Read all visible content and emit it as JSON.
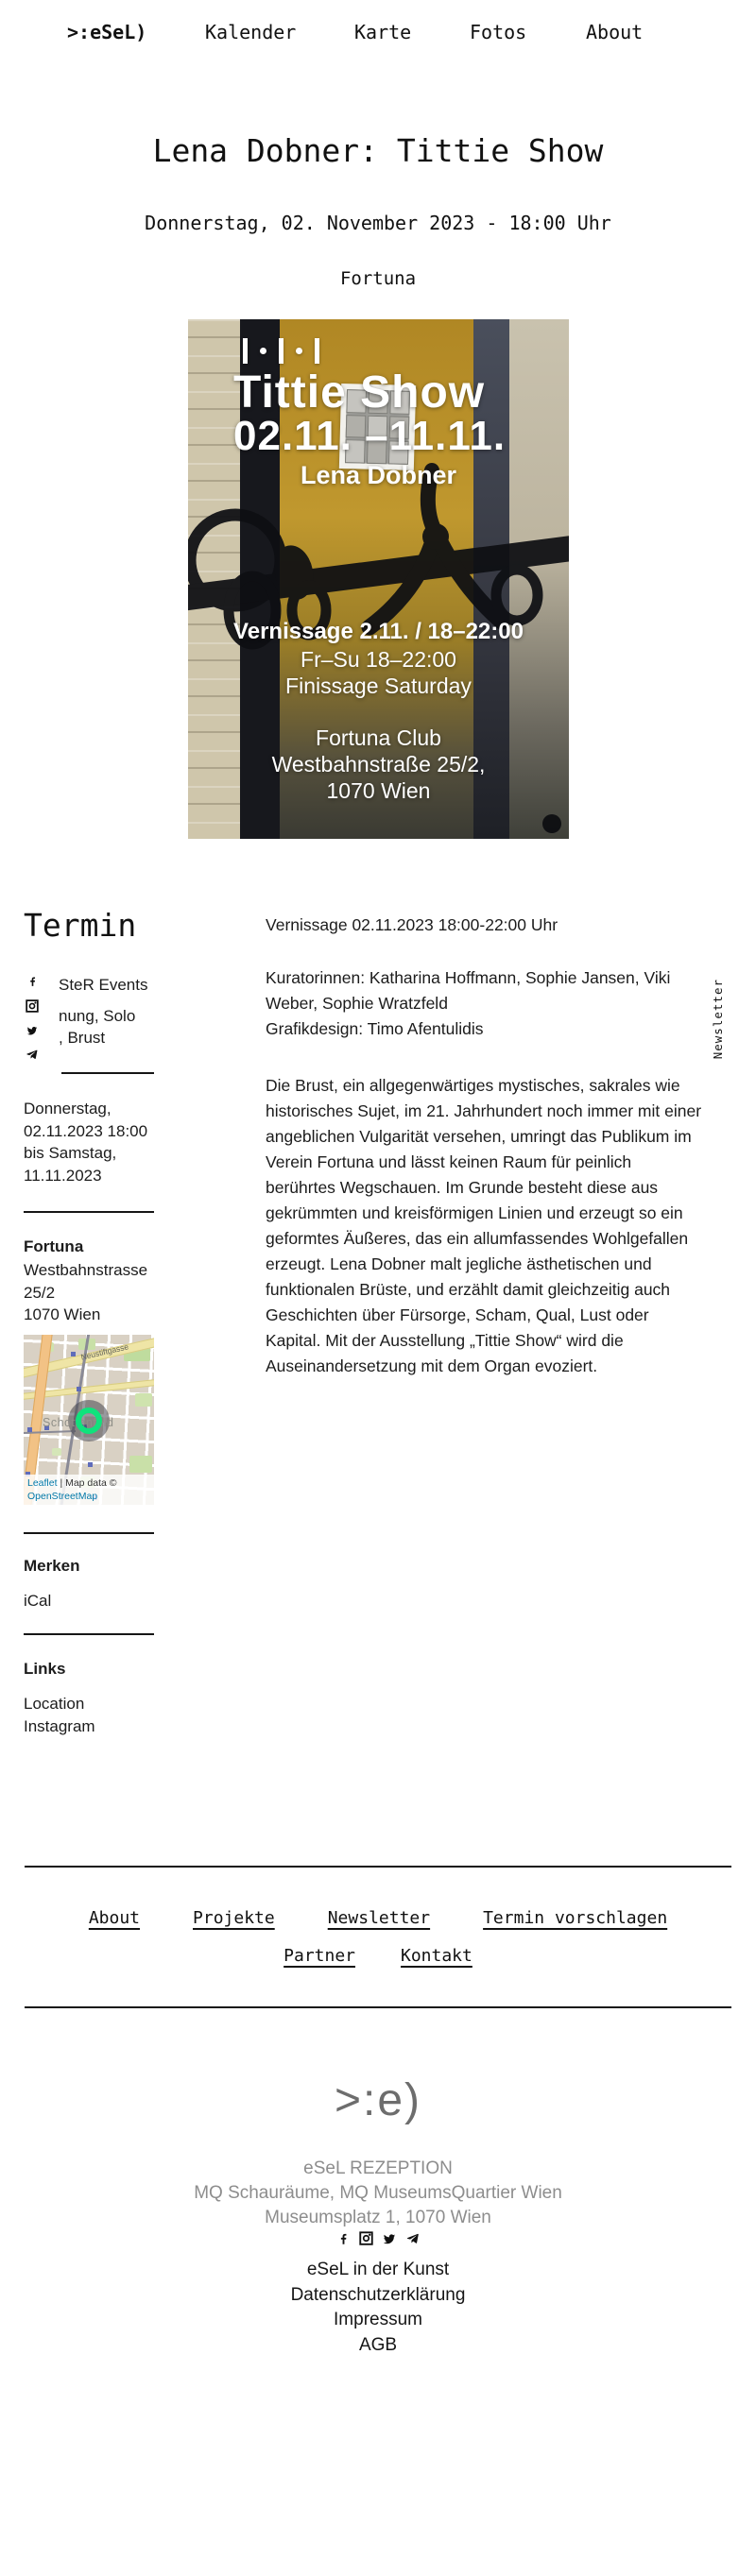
{
  "nav": {
    "logo": ">:eSeL)",
    "items": [
      "Kalender",
      "Karte",
      "Fotos",
      "About"
    ]
  },
  "event": {
    "title": "Lena Dobner: Tittie Show",
    "date_line": "Donnerstag, 02. November 2023 - 18:00 Uhr",
    "venue": "Fortuna"
  },
  "poster": {
    "title": "Tittie Show",
    "dates": "02.11. –11.11.",
    "artist": "Lena Dobner",
    "info_lines": [
      "Vernissage 2.11. / 18–22:00",
      "Fr–Su 18–22:00",
      "Finissage Saturday"
    ],
    "venue_lines": [
      "Fortuna Club",
      "Westbahnstraße 25/2,",
      "1070 Wien"
    ]
  },
  "sidebar": {
    "heading": "Termin",
    "social_icons": [
      "facebook-icon",
      "instagram-icon",
      "twitter-icon",
      "telegram-icon"
    ],
    "tag_fragments": [
      "SteR Events",
      "nung, Solo",
      ", Brust"
    ],
    "datetime_lines": [
      "Donnerstag,",
      "02.11.2023 18:00",
      "bis Samstag,",
      "11.11.2023"
    ],
    "venue": {
      "name": "Fortuna",
      "address_lines": [
        "Westbahnstrasse",
        "25/2",
        "1070 Wien"
      ]
    },
    "map": {
      "area_label": "Schottenfeld",
      "street_label": "Neustiftgasse",
      "attribution_leaflet": "Leaflet",
      "attribution_mid": " | Map data © ",
      "attribution_osm": "OpenStreetMap"
    },
    "merken_heading": "Merken",
    "merken_item": "iCal",
    "links_heading": "Links",
    "link_items": [
      "Location",
      "Instagram"
    ]
  },
  "main": {
    "vernissage_line": "Vernissage 02.11.2023 18:00-22:00 Uhr",
    "credits_lines": [
      "Kuratorinnen: Katharina Hoffmann, Sophie Jansen, Viki",
      "Weber, Sophie Wratzfeld",
      "Grafikdesign: Timo Afentulidis"
    ],
    "body_text": "Die Brust, ein allgegenwärtiges mystisches, sakrales wie\nhistorisches Sujet, im 21. Jahrhundert noch immer mit einer\nangeblichen Vulgarität versehen, umringt das Publikum im\nVerein Fortuna und lässt keinen Raum für peinlich\nberührtes Wegschauen. Im Grunde besteht diese aus\ngekrümmten und kreisförmigen Linien und erzeugt so ein\ngeformtes Äußeres, das ein allumfassendes Wohlgefallen\nerzeugt. Lena Dobner malt jegliche ästhetischen und\nfunktionalen Brüste, und erzählt damit gleichzeitig auch\nGeschichten über Fürsorge, Scham, Qual, Lust oder\nKapital. Mit der Ausstellung „Tittie Show“ wird die\nAuseinandersetzung mit dem Organ evoziert."
  },
  "newsletter_tab": "Newsletter",
  "footer": {
    "nav_row1": [
      "About",
      "Projekte",
      "Newsletter",
      "Termin vorschlagen"
    ],
    "nav_row2": [
      "Partner",
      "Kontakt"
    ],
    "logo": ">:e)",
    "address_lines": [
      "eSeL REZEPTION",
      "MQ Schauräume, MQ MuseumsQuartier Wien",
      "Museumsplatz 1, 1070 Wien"
    ],
    "links": [
      "eSeL in der Kunst",
      "Datenschutzerklärung",
      "Impressum",
      "AGB"
    ]
  },
  "colors": {
    "map_link_blue": "#0078A8",
    "marker_green": "#10e27c",
    "poster_mustard": "#b98f28",
    "footer_gray": "#8d8d8d"
  }
}
